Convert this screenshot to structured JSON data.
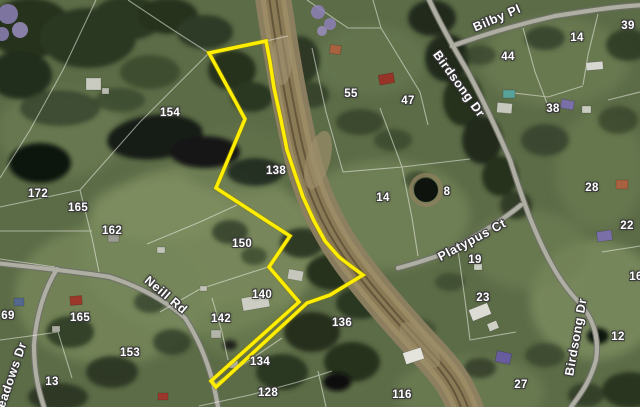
{
  "map": {
    "description_label": "satellite parcel map with highlighted property boundary",
    "colors": {
      "boundary": "#ffee00",
      "label_text": "#ffffff",
      "label_outline": "#3a3a3a",
      "highway": "#8d8060",
      "minor_road": "#aeaea2"
    },
    "roads": {
      "bilby": "Bilby Pl",
      "birdsong_top": "Birdsong Dr",
      "birdsong_bottom": "Birdsong Dr",
      "platypus": "Platypus Ct",
      "neill": "Neill Rd",
      "meadows": "Meadows Dr"
    },
    "lots": [
      {
        "n": "154"
      },
      {
        "n": "138"
      },
      {
        "n": "172"
      },
      {
        "n": "165"
      },
      {
        "n": "162"
      },
      {
        "n": "150"
      },
      {
        "n": "140"
      },
      {
        "n": "142"
      },
      {
        "n": "165"
      },
      {
        "n": "153"
      },
      {
        "n": "134"
      },
      {
        "n": "128"
      },
      {
        "n": "13"
      },
      {
        "n": "69"
      },
      {
        "n": "55"
      },
      {
        "n": "47"
      },
      {
        "n": "44"
      },
      {
        "n": "14"
      },
      {
        "n": "39"
      },
      {
        "n": "38"
      },
      {
        "n": "8"
      },
      {
        "n": "28"
      },
      {
        "n": "14"
      },
      {
        "n": "19"
      },
      {
        "n": "23"
      },
      {
        "n": "22"
      },
      {
        "n": "16"
      },
      {
        "n": "12"
      },
      {
        "n": "27"
      },
      {
        "n": "136"
      },
      {
        "n": "116"
      }
    ]
  }
}
